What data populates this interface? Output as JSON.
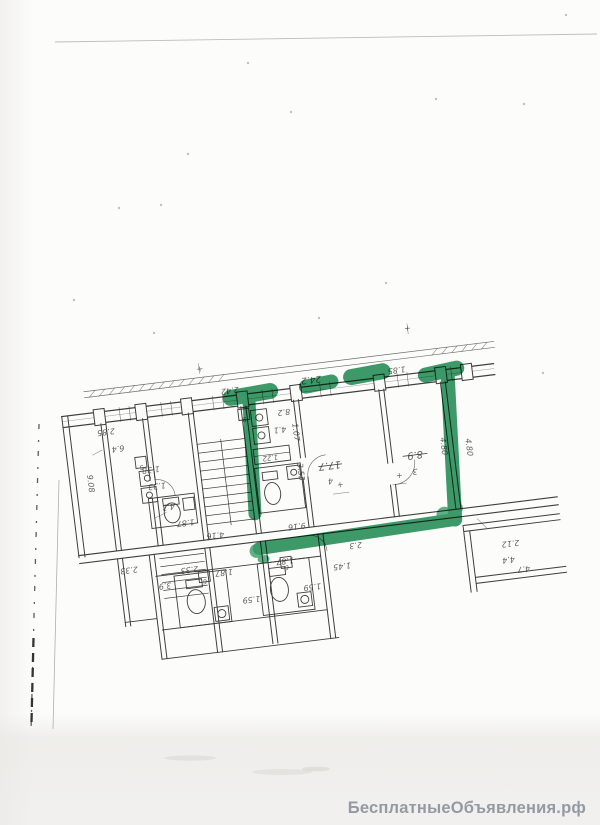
{
  "page": {
    "watermark": "БесплатныеОбъявления.рф",
    "watermark_color": "#949aa3"
  },
  "plan": {
    "description": "scanned apartment floor plan, text upside-down, one flat outlined with green marker",
    "ink_color": "#3f3e3a",
    "highlight_color": "#1a8a50",
    "speck_color": "#9a9892",
    "rotation_deg": -7,
    "labels": [
      {
        "t": "2.85",
        "x": 112,
        "y": 406
      },
      {
        "t": "6.4",
        "x": 122,
        "y": 424
      },
      {
        "t": "9.08",
        "x": 88,
        "y": 458,
        "r": 90
      },
      {
        "t": "1.38",
        "x": 152,
        "y": 449
      },
      {
        "t": "1.33",
        "x": 156,
        "y": 466
      },
      {
        "t": "4.3",
        "x": 165,
        "y": 488
      },
      {
        "t": "1.87",
        "x": 180,
        "y": 506
      },
      {
        "t": "2.42",
        "x": 240,
        "y": 380
      },
      {
        "t": "24.2",
        "x": 322,
        "y": 379,
        "s": 9
      },
      {
        "t": "1.85",
        "x": 408,
        "y": 380
      },
      {
        "t": "8.2",
        "x": 291,
        "y": 408
      },
      {
        "t": "4.1",
        "x": 285,
        "y": 425
      },
      {
        "t": "1.22",
        "x": 272,
        "y": 452,
        "s": 7
      },
      {
        "t": "1.07",
        "x": 298,
        "y": 432,
        "r": 90
      },
      {
        "t": "3.53",
        "x": 298,
        "y": 472,
        "r": 90
      },
      {
        "t": "17.7",
        "x": 330,
        "y": 466,
        "s": 10
      },
      {
        "t": "4",
        "x": 329,
        "y": 482
      },
      {
        "t": "8.9",
        "x": 416,
        "y": 466,
        "s": 10
      },
      {
        "t": "3",
        "x": 414,
        "y": 483
      },
      {
        "t": "4.80",
        "x": 443,
        "y": 464,
        "r": 90
      },
      {
        "t": "4.80",
        "x": 468,
        "y": 468,
        "r": 90
      },
      {
        "t": "4.16",
        "x": 208,
        "y": 522
      },
      {
        "t": "9.16",
        "x": 290,
        "y": 523
      },
      {
        "t": "2.33",
        "x": 118,
        "y": 546
      },
      {
        "t": "2.33",
        "x": 178,
        "y": 553
      },
      {
        "t": "3.9",
        "x": 152,
        "y": 566
      },
      {
        "t": "1.87",
        "x": 212,
        "y": 560
      },
      {
        "t": "1.87",
        "x": 274,
        "y": 556
      },
      {
        "t": "1.59",
        "x": 236,
        "y": 590
      },
      {
        "t": "1.59",
        "x": 298,
        "y": 585
      },
      {
        "t": "1.45",
        "x": 330,
        "y": 568
      },
      {
        "t": "2.3",
        "x": 346,
        "y": 549
      },
      {
        "t": "2.12",
        "x": 500,
        "y": 566
      },
      {
        "t": "4.4",
        "x": 496,
        "y": 582
      },
      {
        "t": "4.7",
        "x": 510,
        "y": 593
      },
      {
        "t": "9",
        "x": 251,
        "y": 411,
        "box": 1
      },
      {
        "t": "5",
        "x": 143,
        "y": 446,
        "box": 1
      },
      {
        "t": "6",
        "x": 192,
        "y": 567,
        "box": 1
      },
      {
        "t": "6",
        "x": 275,
        "y": 563,
        "box": 1
      },
      {
        "t": "+",
        "x": 338,
        "y": 492,
        "r": 0
      },
      {
        "t": "+",
        "x": 398,
        "y": 490,
        "r": 0
      },
      {
        "t": "+",
        "x": 213,
        "y": 360,
        "r": 0
      },
      {
        "t": "+",
        "x": 424,
        "y": 345,
        "r": 0
      }
    ],
    "specks": [
      [
        248,
        63
      ],
      [
        291,
        112
      ],
      [
        188,
        154
      ],
      [
        436,
        99
      ],
      [
        524,
        104
      ],
      [
        119,
        208
      ],
      [
        161,
        205
      ],
      [
        386,
        283
      ],
      [
        319,
        318
      ],
      [
        154,
        333
      ],
      [
        543,
        373
      ],
      [
        566,
        15
      ],
      [
        74,
        300
      ]
    ]
  }
}
